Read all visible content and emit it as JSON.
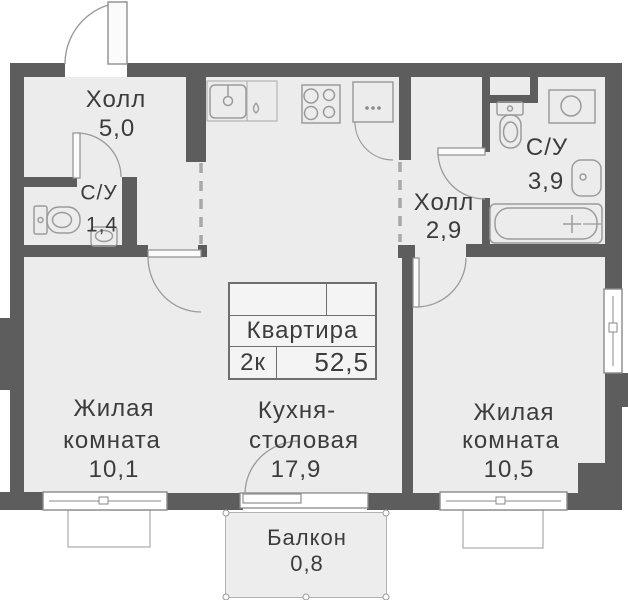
{
  "rooms": {
    "hall_top": {
      "label": "Холл",
      "area": "5,0"
    },
    "wc_small": {
      "label": "С/У",
      "area": "1,4"
    },
    "wc_large": {
      "label": "С/У",
      "area": "3,9"
    },
    "hall_right": {
      "label": "Холл",
      "area": "2,9"
    },
    "living_left": {
      "label_line1": "Жилая",
      "label_line2": "комната",
      "area": "10,1"
    },
    "kitchen": {
      "label_line1": "Кухня-",
      "label_line2": "столовая",
      "area": "17,9"
    },
    "living_right": {
      "label_line1": "Жилая",
      "label_line2": "комната",
      "area": "10,5"
    },
    "balcony": {
      "label": "Балкон",
      "area": "0,8"
    }
  },
  "info_box": {
    "title": "Квартира",
    "rooms_count": "2к",
    "total_area": "52,5"
  },
  "fixtures": {
    "kitchen": [
      "kitchen-sink-icon",
      "water-drop-icon",
      "stove-icon",
      "fridge-icon"
    ],
    "wc_small": [
      "toilet-icon",
      "corner-sink-icon"
    ],
    "wc_large": [
      "toilet-icon",
      "washing-machine-icon",
      "wall-sink-icon",
      "bathtub-icon"
    ]
  },
  "colors": {
    "wall": "#5d5d5d",
    "floor": "#ececec",
    "fixture_line": "#9b9b9b",
    "text": "#3c3c3c"
  }
}
